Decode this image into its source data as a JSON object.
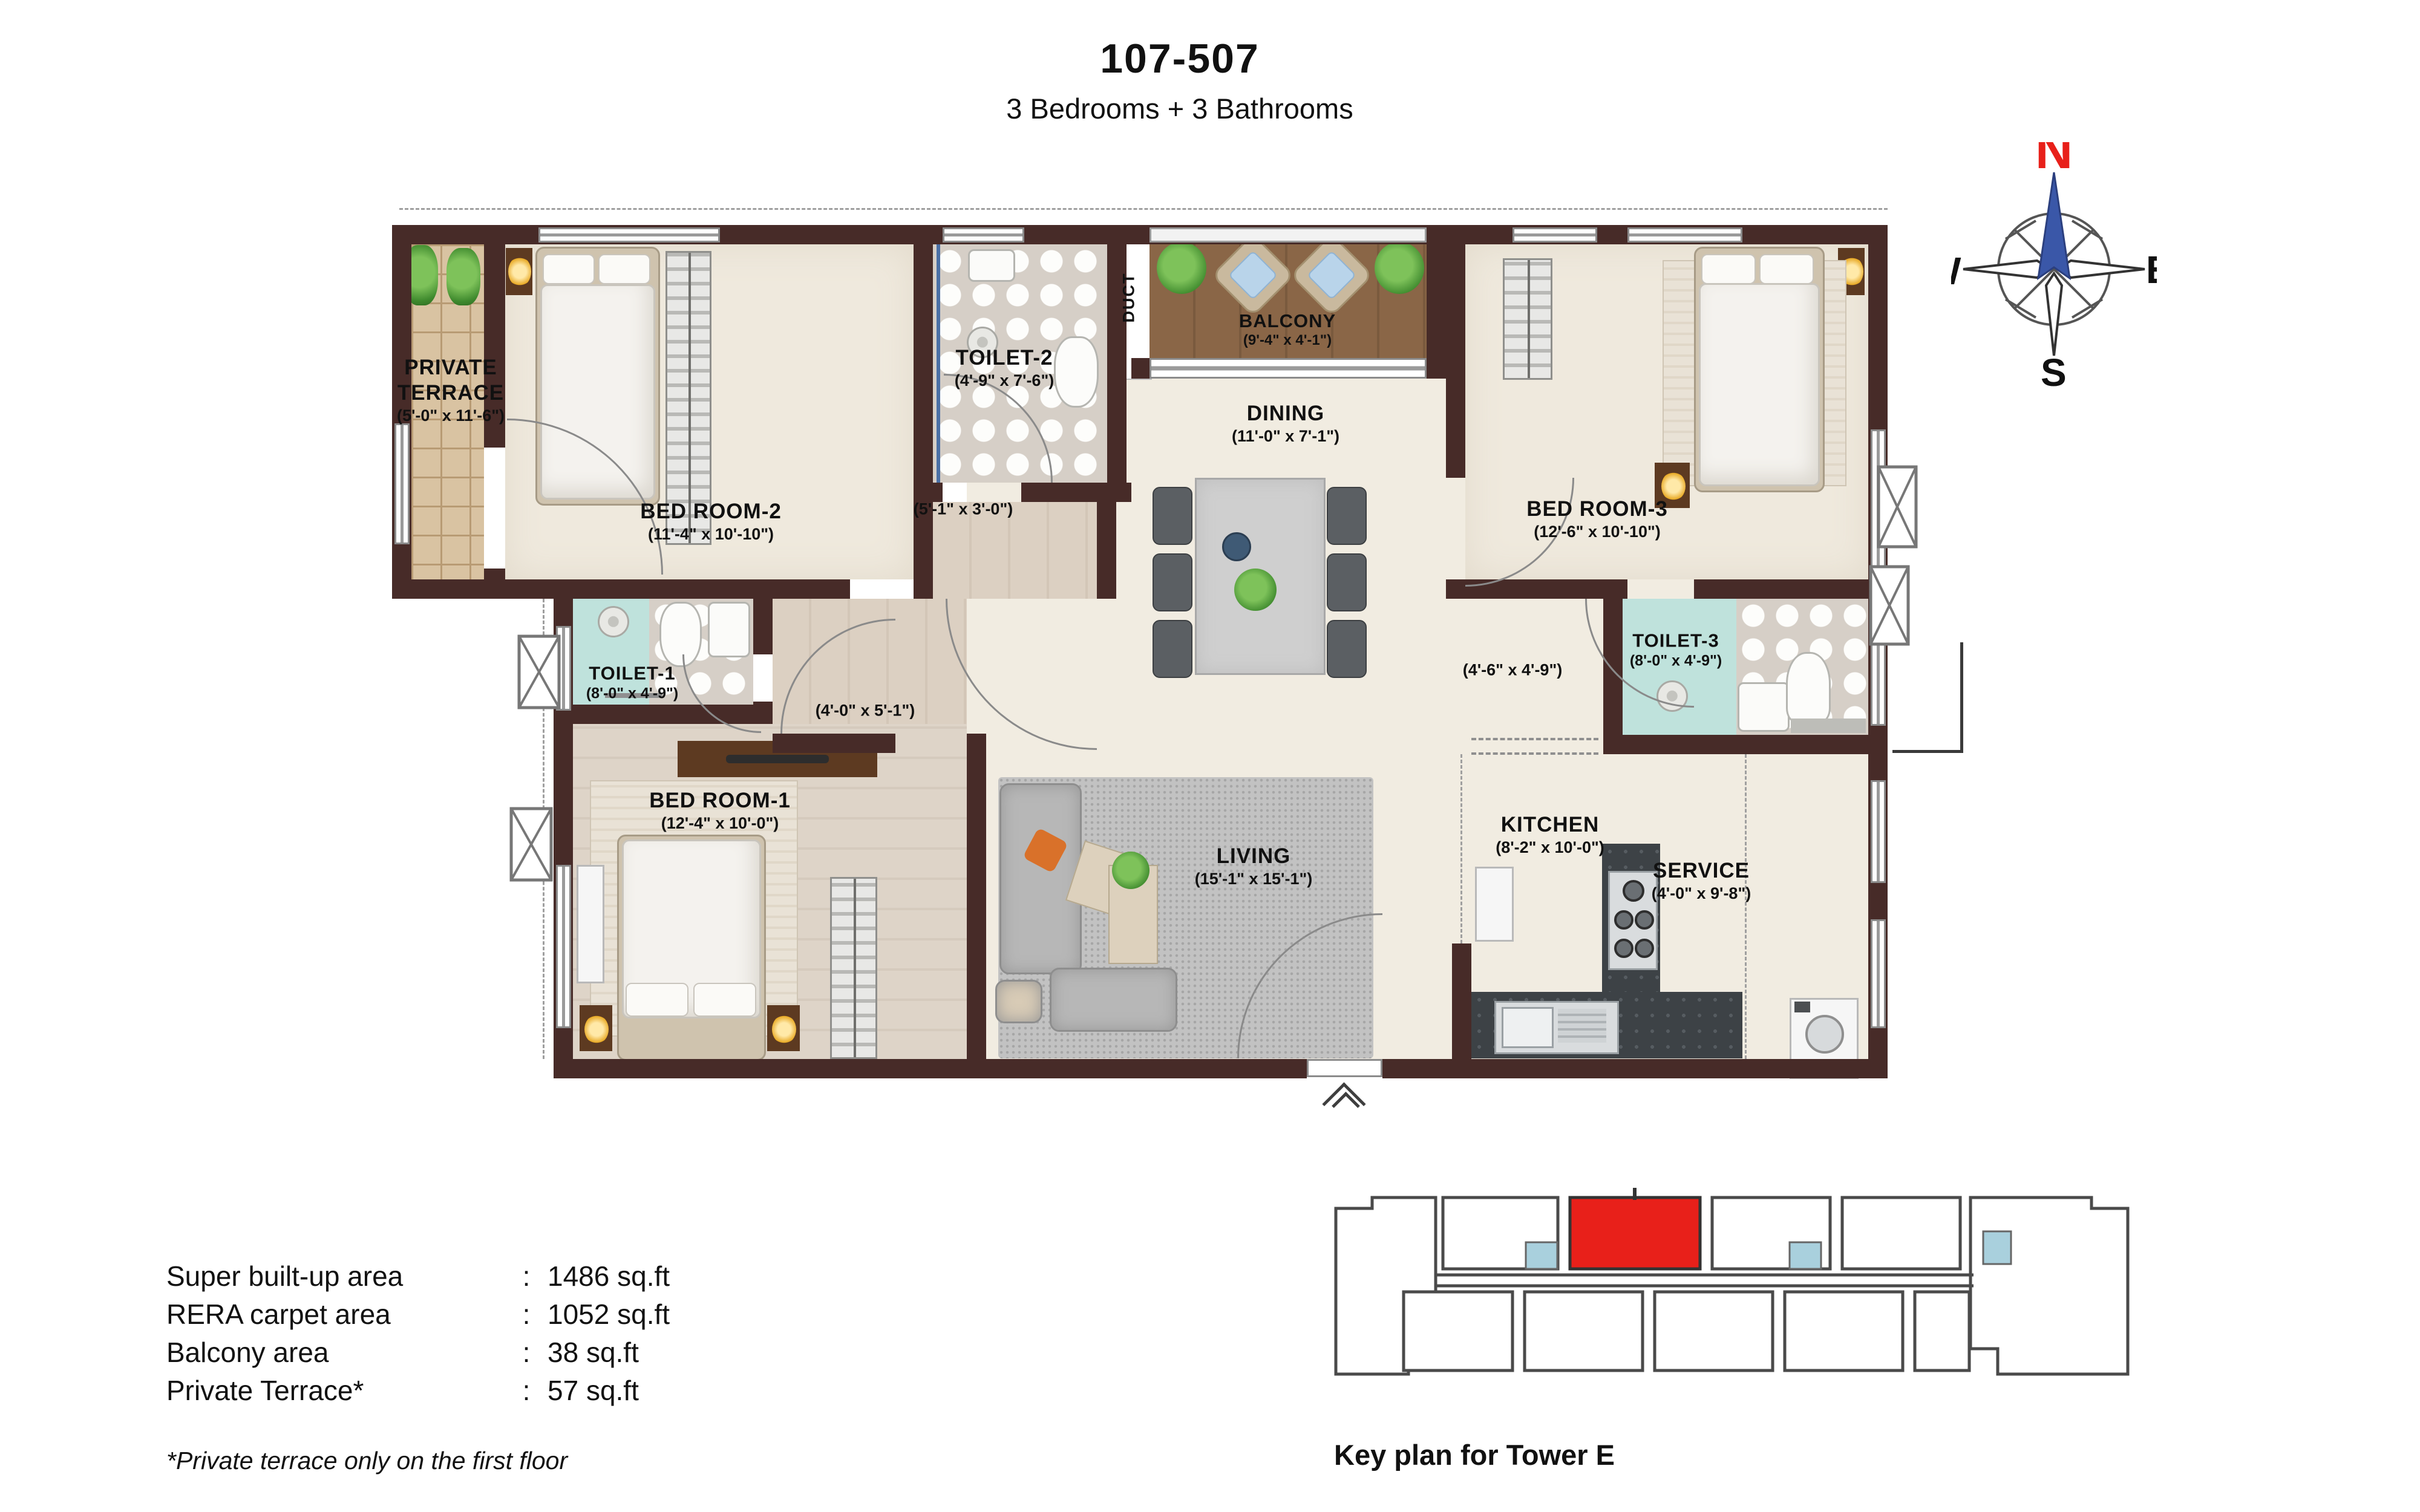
{
  "header": {
    "unit_number": "107-507",
    "subtitle": "3 Bedrooms + 3 Bathrooms"
  },
  "compass": {
    "north": "N",
    "east": "E",
    "south": "S",
    "west": "W"
  },
  "rooms": [
    {
      "id": "private-terrace",
      "name": "PRIVATE TERRACE",
      "dims": "(5'-0\" x 11'-6\")"
    },
    {
      "id": "bed-room-2",
      "name": "BED ROOM-2",
      "dims": "(11'-4\" x 10'-10\")"
    },
    {
      "id": "toilet-2",
      "name": "TOILET-2",
      "dims": "(4'-9\" x 7'-6\")"
    },
    {
      "id": "duct",
      "name": "DUCT",
      "dims": ""
    },
    {
      "id": "balcony",
      "name": "BALCONY",
      "dims": "(9'-4\" x 4'-1\")"
    },
    {
      "id": "dining",
      "name": "DINING",
      "dims": "(11'-0\" x 7'-1\")"
    },
    {
      "id": "bed-room-3",
      "name": "BED ROOM-3",
      "dims": "(12'-6\" x 10'-10\")"
    },
    {
      "id": "toilet-3",
      "name": "TOILET-3",
      "dims": "(8'-0\" x 4'-9\")"
    },
    {
      "id": "toilet-1",
      "name": "TOILET-1",
      "dims": "(8'-0\" x 4'-9\")"
    },
    {
      "id": "bed-room-1",
      "name": "BED ROOM-1",
      "dims": "(12'-4\" x 10'-0\")"
    },
    {
      "id": "living",
      "name": "LIVING",
      "dims": "(15'-1\" x 15'-1\")"
    },
    {
      "id": "kitchen",
      "name": "KITCHEN",
      "dims": "(8'-2\" x 10'-0\")"
    },
    {
      "id": "service",
      "name": "SERVICE",
      "dims": "(4'-0\" x 9'-8\")"
    }
  ],
  "passages": [
    {
      "dims": "(5'-1\" x 3'-0\")"
    },
    {
      "dims": "(4'-0\" x 5'-1\")"
    },
    {
      "dims": "(4'-6\" x 4'-9\")"
    }
  ],
  "area_table": {
    "rows": [
      {
        "label": "Super built-up area",
        "separator": ":",
        "value": "1486 sq.ft"
      },
      {
        "label": "RERA carpet area",
        "separator": ":",
        "value": "1052 sq.ft"
      },
      {
        "label": "Balcony area",
        "separator": ":",
        "value": "38 sq.ft"
      },
      {
        "label": "Private Terrace*",
        "separator": ":",
        "value": "57 sq.ft"
      }
    ],
    "footnote": "*Private terrace only on the first floor"
  },
  "key_plan": {
    "caption": "Key plan for Tower E"
  },
  "colors": {
    "wall": "#472b28",
    "highlight_unit": "#e8201a",
    "compass_north": "#e8201a",
    "compass_needle": "#3a57a8",
    "toilet_mint": "#bfe2dc",
    "balcony_wood": "#8a6647"
  }
}
